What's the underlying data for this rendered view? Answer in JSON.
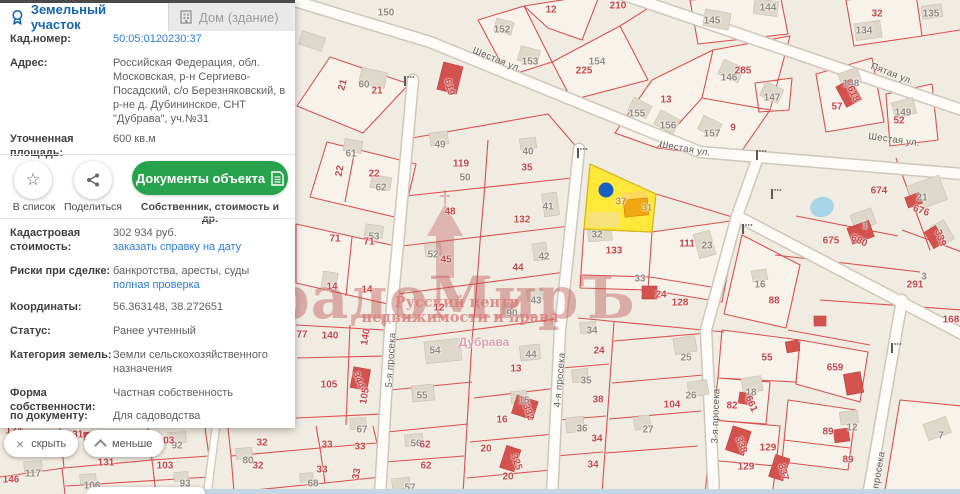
{
  "window": {
    "width": 960,
    "height": 494
  },
  "colors": {
    "accent_blue": "#1465b0",
    "link_blue": "#2e7cd6",
    "button_green": "#28a24c",
    "parcel_red": "#d95050",
    "selected_yellow": "#ffe83a",
    "selected_marker_blue": "#1660c4",
    "map_background": "#f1ece2",
    "watermark_red": "rgba(184,76,76,0.4)"
  },
  "panel": {
    "tabs": [
      {
        "label": "Земельный участок",
        "icon": "badge-icon",
        "active": true
      },
      {
        "label": "Дом (здание)",
        "icon": "building-icon",
        "active": false
      }
    ],
    "fields": {
      "cadastral_number": {
        "label": "Кад.номер:",
        "value": "50:05:0120230:37"
      },
      "address": {
        "label": "Адрес:",
        "value": "Российская Федерация, обл. Московская, р-н Сергиево-Посадский, с/о Березняковский, в р-не д. Дубининское, СНТ \"Дубрава\", уч.№31"
      },
      "refined_area": {
        "label": "Уточненная площадь:",
        "value": "600 кв.м"
      },
      "cadastral_cost": {
        "label": "Кадастровая стоимость:",
        "value": "302 934 руб.",
        "link": "заказать справку на дату"
      },
      "risks": {
        "label": "Риски при сделке:",
        "value": "банкротства, аресты, суды",
        "link": "полная проверка"
      },
      "coordinates": {
        "label": "Координаты:",
        "value": "56.363148, 38.272651"
      },
      "status": {
        "label": "Статус:",
        "value": "Ранее учтенный"
      },
      "land_category": {
        "label": "Категория земель:",
        "value": "Земли сельскохозяйственного назначения"
      },
      "ownership": {
        "label": "Форма собственности:",
        "value": "Частная собственность"
      },
      "by_document": {
        "label": "по документу:",
        "value": "Для садоводства"
      }
    },
    "actions": {
      "to_list": "В список",
      "share": "Поделиться",
      "documents_button": "Документы объекта",
      "documents_caption": "Собственник, стоимость и др."
    }
  },
  "map_controls": {
    "hide": "скрыть",
    "less": "меньше"
  },
  "map": {
    "selected_parcel": {
      "number": "37",
      "building_number": "31",
      "cadastral_number": "50:05:0120230:37"
    },
    "watermark": {
      "title": "ГрадоМирЪ",
      "subtitle1": "Русский центр",
      "subtitle2": "недвижимости и права"
    },
    "labels": [
      {
        "t": "Шестая ул.",
        "x": 497,
        "y": 60,
        "k": "st",
        "r": 22
      },
      {
        "t": "Шестая ул.",
        "x": 685,
        "y": 149,
        "k": "st",
        "r": 10
      },
      {
        "t": "Шестая ул.",
        "x": 894,
        "y": 140,
        "k": "st",
        "r": 8
      },
      {
        "t": "Пятая ул.",
        "x": 892,
        "y": 74,
        "k": "st",
        "r": 21
      },
      {
        "t": "5-я просека",
        "x": 391,
        "y": 360,
        "k": "st",
        "r": -86
      },
      {
        "t": "4-я просека",
        "x": 560,
        "y": 380,
        "k": "st",
        "r": -85
      },
      {
        "t": "3-я просека",
        "x": 716,
        "y": 416,
        "k": "st",
        "r": -88
      },
      {
        "t": "просека",
        "x": 879,
        "y": 470,
        "k": "st",
        "r": -80
      },
      {
        "t": "Дубрава",
        "x": 484,
        "y": 342,
        "k": "pl"
      },
      {
        "t": "37",
        "x": 621,
        "y": 202,
        "k": "sel"
      },
      {
        "t": "31",
        "x": 647,
        "y": 208,
        "k": "selb"
      },
      {
        "t": "150",
        "x": 386,
        "y": 13,
        "k": "g"
      },
      {
        "t": "152",
        "x": 502,
        "y": 30,
        "k": "g"
      },
      {
        "t": "153",
        "x": 530,
        "y": 62,
        "k": "g"
      },
      {
        "t": "154",
        "x": 597,
        "y": 62,
        "k": "g"
      },
      {
        "t": "60",
        "x": 364,
        "y": 85,
        "k": "g"
      },
      {
        "t": "61",
        "x": 351,
        "y": 154,
        "k": "g"
      },
      {
        "t": "49",
        "x": 440,
        "y": 145,
        "k": "g"
      },
      {
        "t": "40",
        "x": 528,
        "y": 152,
        "k": "g"
      },
      {
        "t": "50",
        "x": 465,
        "y": 178,
        "k": "g"
      },
      {
        "t": "144",
        "x": 768,
        "y": 8,
        "k": "g"
      },
      {
        "t": "145",
        "x": 712,
        "y": 21,
        "k": "g"
      },
      {
        "t": "134",
        "x": 864,
        "y": 31,
        "k": "g"
      },
      {
        "t": "135",
        "x": 931,
        "y": 14,
        "k": "g"
      },
      {
        "t": "146",
        "x": 729,
        "y": 78,
        "k": "g"
      },
      {
        "t": "155",
        "x": 637,
        "y": 114,
        "k": "g"
      },
      {
        "t": "156",
        "x": 668,
        "y": 126,
        "k": "g"
      },
      {
        "t": "147",
        "x": 772,
        "y": 98,
        "k": "g"
      },
      {
        "t": "157",
        "x": 712,
        "y": 134,
        "k": "g"
      },
      {
        "t": "148",
        "x": 851,
        "y": 84,
        "k": "g"
      },
      {
        "t": "149",
        "x": 903,
        "y": 113,
        "k": "g"
      },
      {
        "t": "21",
        "x": 922,
        "y": 198,
        "k": "g"
      },
      {
        "t": "62",
        "x": 381,
        "y": 188,
        "k": "g"
      },
      {
        "t": "53",
        "x": 374,
        "y": 237,
        "k": "g"
      },
      {
        "t": "41",
        "x": 548,
        "y": 207,
        "k": "g"
      },
      {
        "t": "52",
        "x": 433,
        "y": 255,
        "k": "g"
      },
      {
        "t": "42",
        "x": 544,
        "y": 257,
        "k": "g"
      },
      {
        "t": "43",
        "x": 536,
        "y": 301,
        "k": "g"
      },
      {
        "t": "90",
        "x": 512,
        "y": 314,
        "k": "g"
      },
      {
        "t": "54",
        "x": 435,
        "y": 351,
        "k": "g"
      },
      {
        "t": "55",
        "x": 422,
        "y": 396,
        "k": "g"
      },
      {
        "t": "56",
        "x": 416,
        "y": 444,
        "k": "g"
      },
      {
        "t": "57",
        "x": 410,
        "y": 488,
        "k": "g"
      },
      {
        "t": "44",
        "x": 531,
        "y": 355,
        "k": "g"
      },
      {
        "t": "15",
        "x": 524,
        "y": 401,
        "k": "g"
      },
      {
        "t": "34",
        "x": 592,
        "y": 331,
        "k": "g"
      },
      {
        "t": "35",
        "x": 586,
        "y": 381,
        "k": "g"
      },
      {
        "t": "36",
        "x": 582,
        "y": 429,
        "k": "g"
      },
      {
        "t": "32",
        "x": 597,
        "y": 235,
        "k": "g"
      },
      {
        "t": "23",
        "x": 707,
        "y": 246,
        "k": "g"
      },
      {
        "t": "33",
        "x": 640,
        "y": 279,
        "k": "g"
      },
      {
        "t": "16",
        "x": 760,
        "y": 285,
        "k": "g"
      },
      {
        "t": "25",
        "x": 686,
        "y": 358,
        "k": "g"
      },
      {
        "t": "26",
        "x": 691,
        "y": 396,
        "k": "g"
      },
      {
        "t": "27",
        "x": 648,
        "y": 430,
        "k": "g"
      },
      {
        "t": "18",
        "x": 751,
        "y": 393,
        "k": "g"
      },
      {
        "t": "12",
        "x": 852,
        "y": 428,
        "k": "g"
      },
      {
        "t": "7",
        "x": 941,
        "y": 436,
        "k": "g"
      },
      {
        "t": "1",
        "x": 865,
        "y": 226,
        "k": "g"
      },
      {
        "t": "3",
        "x": 924,
        "y": 277,
        "k": "g"
      },
      {
        "t": "92",
        "x": 177,
        "y": 446,
        "k": "g"
      },
      {
        "t": "117",
        "x": 33,
        "y": 474,
        "k": "g"
      },
      {
        "t": "106",
        "x": 92,
        "y": 486,
        "k": "g"
      },
      {
        "t": "93",
        "x": 185,
        "y": 484,
        "k": "g"
      },
      {
        "t": "80",
        "x": 248,
        "y": 461,
        "k": "g"
      },
      {
        "t": "68",
        "x": 313,
        "y": 484,
        "k": "g"
      },
      {
        "t": "67",
        "x": 362,
        "y": 430,
        "k": "g"
      },
      {
        "t": "12",
        "x": 551,
        "y": 10,
        "k": "r"
      },
      {
        "t": "210",
        "x": 618,
        "y": 6,
        "k": "r"
      },
      {
        "t": "225",
        "x": 584,
        "y": 71,
        "k": "r"
      },
      {
        "t": "21",
        "x": 377,
        "y": 91,
        "k": "r"
      },
      {
        "t": "21",
        "x": 343,
        "y": 85,
        "k": "r",
        "r": -75
      },
      {
        "t": "619",
        "x": 449,
        "y": 87,
        "k": "r",
        "r": 75
      },
      {
        "t": "119",
        "x": 461,
        "y": 164,
        "k": "r"
      },
      {
        "t": "35",
        "x": 527,
        "y": 168,
        "k": "r"
      },
      {
        "t": "32",
        "x": 877,
        "y": 14,
        "k": "r"
      },
      {
        "t": "285",
        "x": 743,
        "y": 71,
        "k": "r"
      },
      {
        "t": "13",
        "x": 666,
        "y": 100,
        "k": "r"
      },
      {
        "t": "9",
        "x": 733,
        "y": 128,
        "k": "r"
      },
      {
        "t": "618",
        "x": 853,
        "y": 94,
        "k": "r",
        "r": 65
      },
      {
        "t": "57",
        "x": 837,
        "y": 107,
        "k": "r"
      },
      {
        "t": "52",
        "x": 899,
        "y": 121,
        "k": "r"
      },
      {
        "t": "22",
        "x": 340,
        "y": 171,
        "k": "r",
        "r": -80
      },
      {
        "t": "22",
        "x": 374,
        "y": 174,
        "k": "r"
      },
      {
        "t": "71",
        "x": 335,
        "y": 239,
        "k": "r"
      },
      {
        "t": "71",
        "x": 369,
        "y": 242,
        "k": "r"
      },
      {
        "t": "14",
        "x": 332,
        "y": 287,
        "k": "r"
      },
      {
        "t": "14",
        "x": 367,
        "y": 290,
        "k": "r"
      },
      {
        "t": "132",
        "x": 522,
        "y": 220,
        "k": "r"
      },
      {
        "t": "48",
        "x": 450,
        "y": 212,
        "k": "r"
      },
      {
        "t": "45",
        "x": 446,
        "y": 260,
        "k": "r"
      },
      {
        "t": "44",
        "x": 518,
        "y": 268,
        "k": "r"
      },
      {
        "t": "12",
        "x": 439,
        "y": 308,
        "k": "r"
      },
      {
        "t": "77",
        "x": 302,
        "y": 335,
        "k": "r"
      },
      {
        "t": "140",
        "x": 330,
        "y": 336,
        "k": "r"
      },
      {
        "t": "140",
        "x": 366,
        "y": 337,
        "k": "r",
        "r": -80
      },
      {
        "t": "105",
        "x": 329,
        "y": 385,
        "k": "r"
      },
      {
        "t": "344",
        "x": 358,
        "y": 380,
        "k": "r",
        "r": 70
      },
      {
        "t": "105",
        "x": 365,
        "y": 396,
        "k": "r",
        "r": -80
      },
      {
        "t": "62",
        "x": 425,
        "y": 445,
        "k": "r"
      },
      {
        "t": "62",
        "x": 426,
        "y": 466,
        "k": "r"
      },
      {
        "t": "13",
        "x": 516,
        "y": 369,
        "k": "r"
      },
      {
        "t": "332",
        "x": 528,
        "y": 412,
        "k": "r",
        "r": 70
      },
      {
        "t": "16",
        "x": 502,
        "y": 420,
        "k": "r"
      },
      {
        "t": "20",
        "x": 486,
        "y": 449,
        "k": "r"
      },
      {
        "t": "325",
        "x": 516,
        "y": 462,
        "k": "r",
        "r": 70
      },
      {
        "t": "20",
        "x": 508,
        "y": 477,
        "k": "r"
      },
      {
        "t": "24",
        "x": 599,
        "y": 351,
        "k": "r"
      },
      {
        "t": "38",
        "x": 598,
        "y": 400,
        "k": "r"
      },
      {
        "t": "34",
        "x": 597,
        "y": 439,
        "k": "r"
      },
      {
        "t": "34",
        "x": 593,
        "y": 465,
        "k": "r"
      },
      {
        "t": "133",
        "x": 614,
        "y": 251,
        "k": "r"
      },
      {
        "t": "111",
        "x": 687,
        "y": 244,
        "k": "r"
      },
      {
        "t": "24",
        "x": 661,
        "y": 295,
        "k": "r"
      },
      {
        "t": "128",
        "x": 680,
        "y": 303,
        "k": "r"
      },
      {
        "t": "88",
        "x": 774,
        "y": 301,
        "k": "r"
      },
      {
        "t": "104",
        "x": 672,
        "y": 405,
        "k": "r"
      },
      {
        "t": "55",
        "x": 767,
        "y": 358,
        "k": "r"
      },
      {
        "t": "659",
        "x": 835,
        "y": 368,
        "k": "r"
      },
      {
        "t": "82",
        "x": 732,
        "y": 406,
        "k": "r"
      },
      {
        "t": "661",
        "x": 751,
        "y": 404,
        "k": "r",
        "r": 65
      },
      {
        "t": "338",
        "x": 741,
        "y": 445,
        "k": "r",
        "r": 70
      },
      {
        "t": "129",
        "x": 768,
        "y": 448,
        "k": "r"
      },
      {
        "t": "129",
        "x": 746,
        "y": 467,
        "k": "r"
      },
      {
        "t": "337",
        "x": 783,
        "y": 472,
        "k": "r",
        "r": 75
      },
      {
        "t": "89",
        "x": 828,
        "y": 432,
        "k": "r"
      },
      {
        "t": "89",
        "x": 848,
        "y": 460,
        "k": "r"
      },
      {
        "t": "674",
        "x": 879,
        "y": 191,
        "k": "r"
      },
      {
        "t": "676",
        "x": 921,
        "y": 211,
        "k": "r",
        "r": 20
      },
      {
        "t": "675",
        "x": 831,
        "y": 241,
        "k": "r"
      },
      {
        "t": "680",
        "x": 859,
        "y": 241,
        "k": "r",
        "r": 25
      },
      {
        "t": "339",
        "x": 940,
        "y": 238,
        "k": "r",
        "r": 70
      },
      {
        "t": "291",
        "x": 915,
        "y": 285,
        "k": "r"
      },
      {
        "t": "168",
        "x": 951,
        "y": 320,
        "k": "r"
      },
      {
        "t": "134",
        "x": 14,
        "y": 431,
        "k": "r"
      },
      {
        "t": "131",
        "x": 75,
        "y": 435,
        "k": "r"
      },
      {
        "t": "103",
        "x": 166,
        "y": 441,
        "k": "r"
      },
      {
        "t": "32",
        "x": 262,
        "y": 443,
        "k": "r"
      },
      {
        "t": "131",
        "x": 106,
        "y": 463,
        "k": "r"
      },
      {
        "t": "146",
        "x": 11,
        "y": 480,
        "k": "r"
      },
      {
        "t": "103",
        "x": 165,
        "y": 466,
        "k": "r"
      },
      {
        "t": "32",
        "x": 258,
        "y": 466,
        "k": "r"
      },
      {
        "t": "33",
        "x": 327,
        "y": 445,
        "k": "r"
      },
      {
        "t": "33",
        "x": 360,
        "y": 447,
        "k": "r"
      },
      {
        "t": "33",
        "x": 322,
        "y": 470,
        "k": "r"
      },
      {
        "t": "33",
        "x": 357,
        "y": 474,
        "k": "r",
        "r": -80
      }
    ]
  }
}
